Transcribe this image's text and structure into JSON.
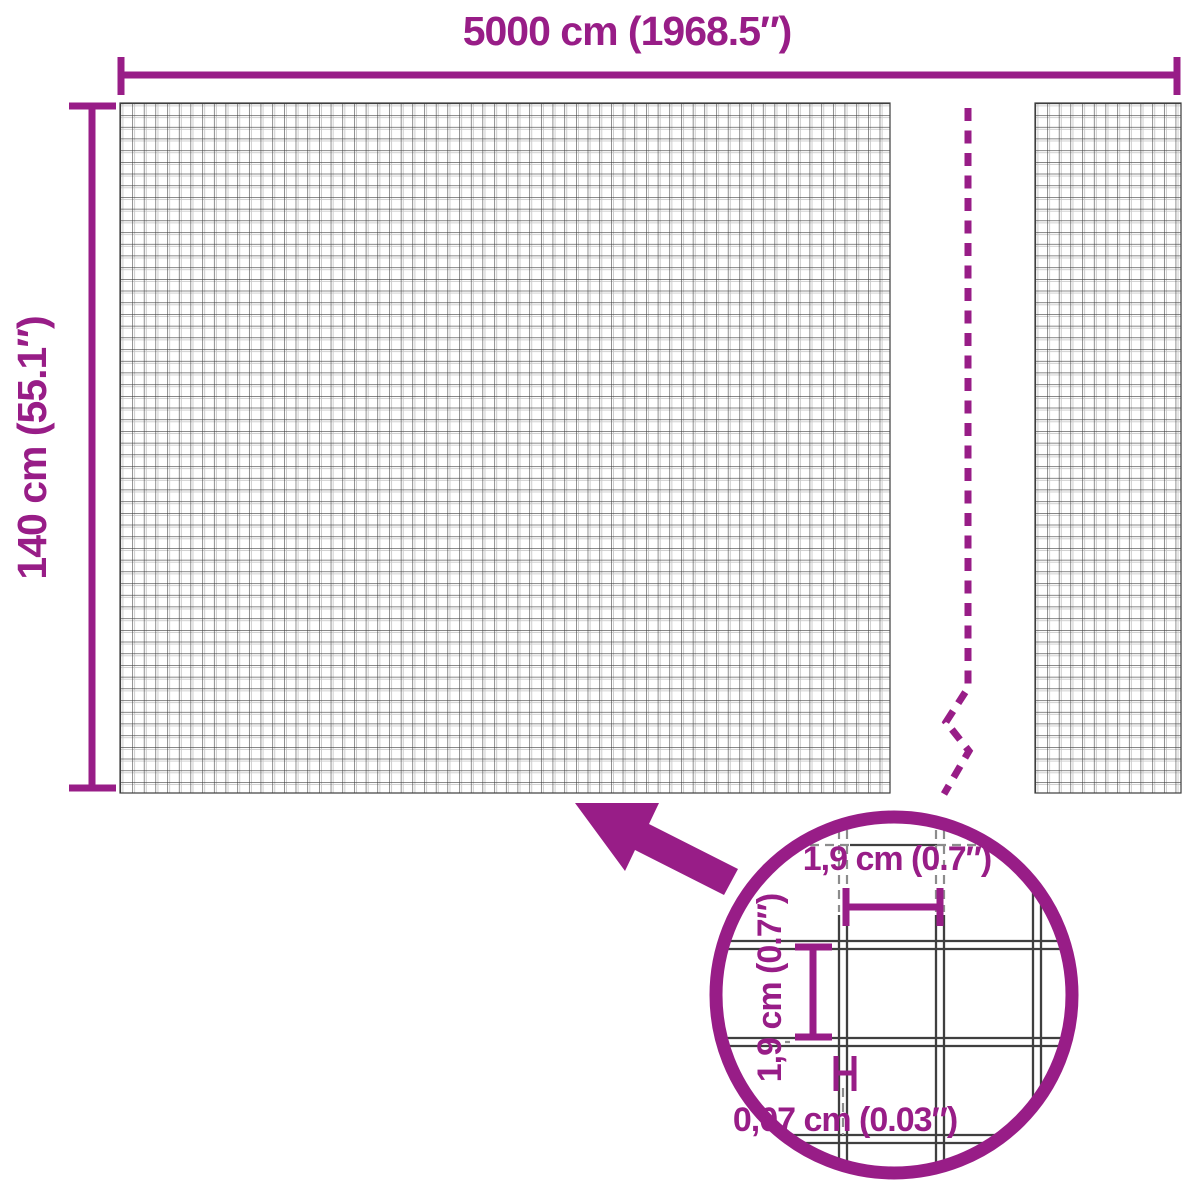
{
  "diagram": {
    "title": "wire-mesh-fence-dimension-diagram",
    "overall": {
      "width_label": "5000 cm (1968.5″)",
      "height_label": "140 cm (55.1″)"
    },
    "detail": {
      "mesh_width_label": "1,9 cm (0.7″)",
      "mesh_height_label": "1,9 cm (0.7″)",
      "wire_thickness_label": "0,07 cm (0.03″)"
    }
  },
  "colors": {
    "accent_purple": "#981D87",
    "mesh_line_dark": "#3D3D3D",
    "mesh_line_light": "#C9C9C9",
    "detail_dash_gray": "#8C8C8C",
    "background": "#FFFFFF"
  }
}
